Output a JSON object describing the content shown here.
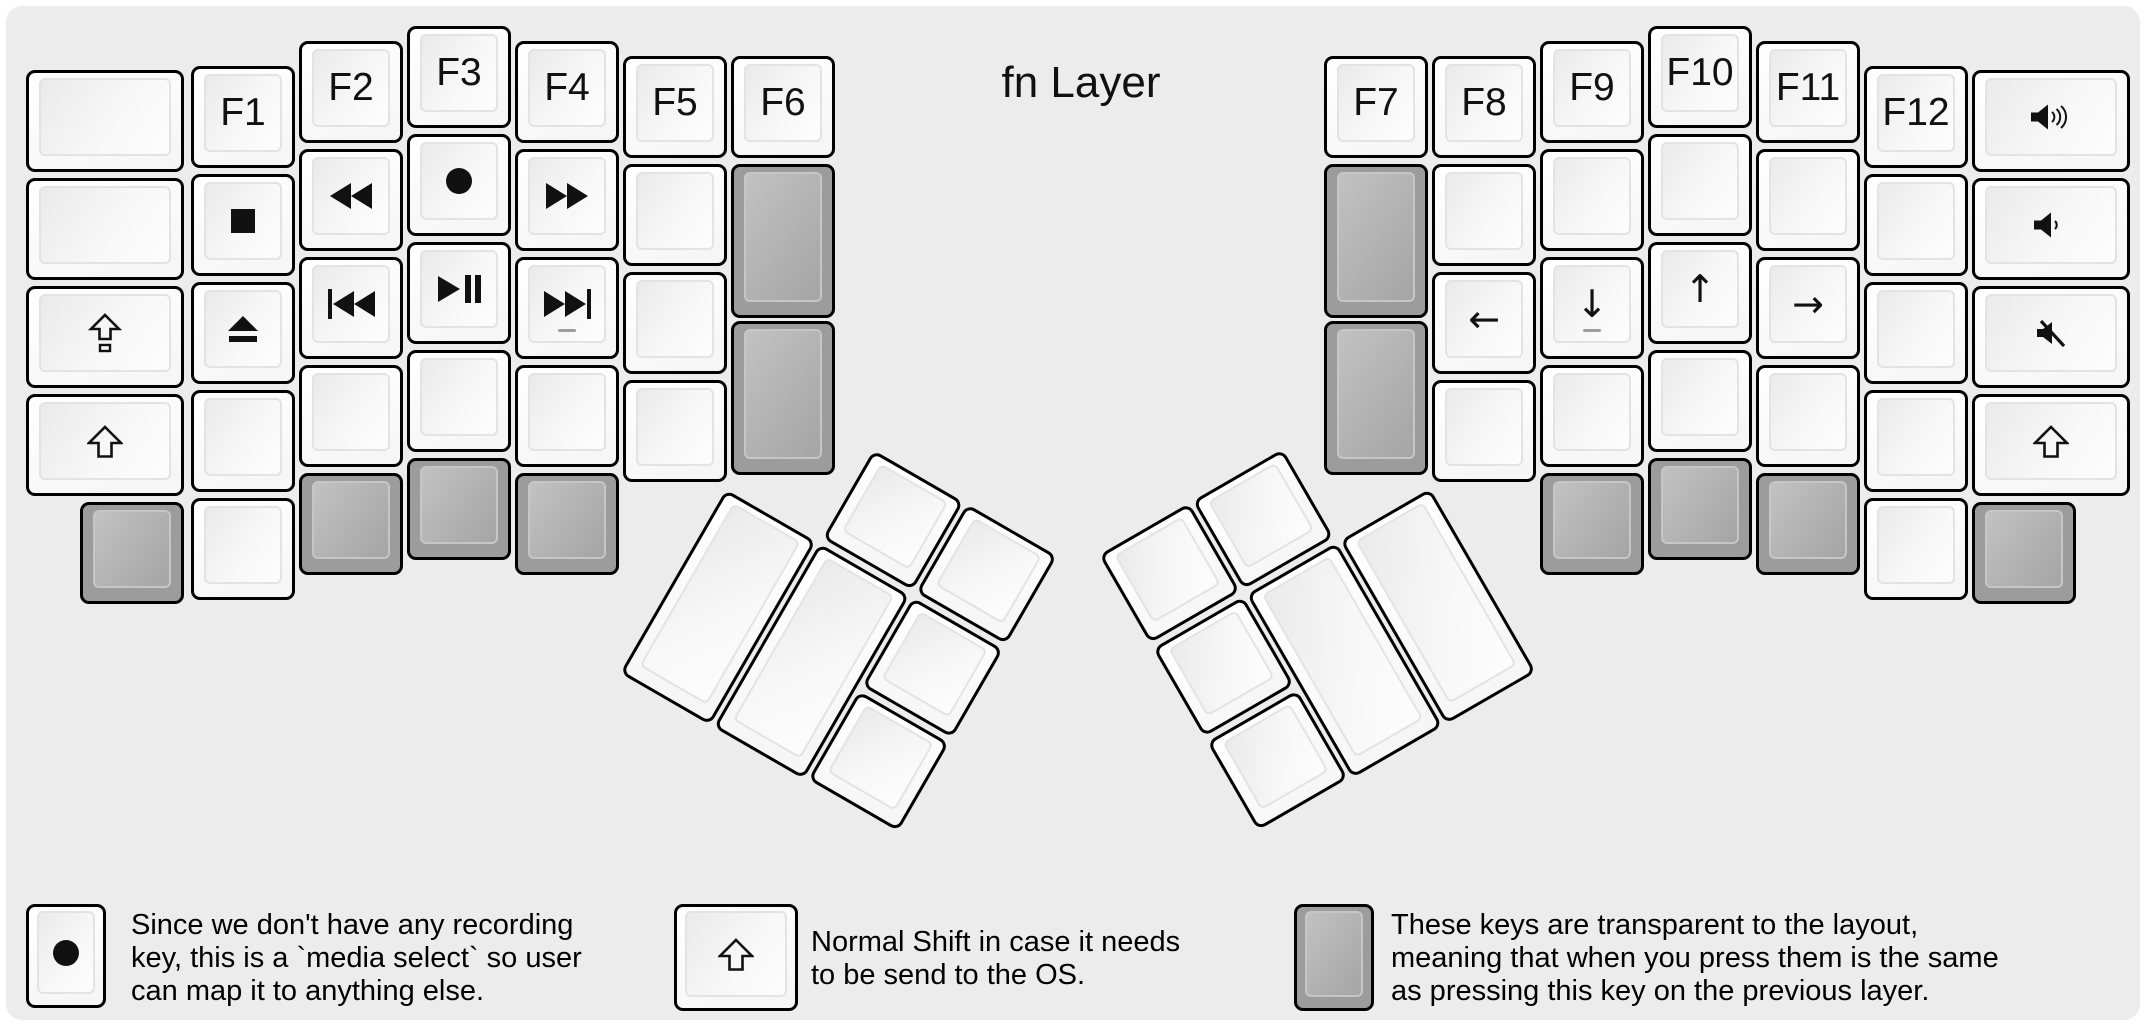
{
  "title": "fn Layer",
  "colors": {
    "panel_background": "#ececec",
    "key_border": "#000000",
    "white_key": "#f7f7f7",
    "transparent_key_gray": "#9c9c9c",
    "icon": "#111111",
    "homing_bar": "#9e9e9e"
  },
  "glyphs": {
    "arrow-left": "←",
    "arrow-down": "↓",
    "arrow-up": "↑",
    "arrow-right": "→"
  },
  "keyboard": {
    "left_main": [
      {
        "name": "blank",
        "x": 20,
        "y": 64,
        "w": 158
      },
      {
        "name": "f1",
        "label": "F1",
        "x": 185,
        "y": 60
      },
      {
        "name": "f2",
        "label": "F2",
        "x": 293,
        "y": 35
      },
      {
        "name": "f3",
        "label": "F3",
        "x": 401,
        "y": 20
      },
      {
        "name": "f4",
        "label": "F4",
        "x": 509,
        "y": 35
      },
      {
        "name": "f5",
        "label": "F5",
        "x": 617,
        "y": 50
      },
      {
        "name": "f6",
        "label": "F6",
        "x": 725,
        "y": 50
      },
      {
        "name": "blank",
        "x": 20,
        "y": 172,
        "w": 158
      },
      {
        "name": "stop",
        "icon": "stop",
        "x": 185,
        "y": 168
      },
      {
        "name": "rewind",
        "icon": "rewind",
        "x": 293,
        "y": 143
      },
      {
        "name": "record",
        "icon": "record",
        "x": 401,
        "y": 128
      },
      {
        "name": "fast-forward",
        "icon": "fast-forward",
        "x": 509,
        "y": 143
      },
      {
        "name": "blank",
        "x": 617,
        "y": 158
      },
      {
        "name": "transparent",
        "type": "gray",
        "x": 725,
        "y": 158,
        "h": 154
      },
      {
        "name": "caps-lock",
        "icon": "caps-lock",
        "x": 20,
        "y": 280,
        "w": 158
      },
      {
        "name": "eject",
        "icon": "eject",
        "x": 185,
        "y": 276
      },
      {
        "name": "prev-track",
        "icon": "prev-track",
        "x": 293,
        "y": 251
      },
      {
        "name": "play-pause",
        "icon": "play-pause",
        "x": 401,
        "y": 236
      },
      {
        "name": "next-track",
        "icon": "next-track",
        "x": 509,
        "y": 251,
        "homing": true
      },
      {
        "name": "blank",
        "x": 617,
        "y": 266
      },
      {
        "name": "transparent",
        "type": "gray",
        "x": 725,
        "y": 315,
        "h": 154
      },
      {
        "name": "shift",
        "icon": "shift",
        "x": 20,
        "y": 388,
        "w": 158
      },
      {
        "name": "blank",
        "x": 185,
        "y": 384
      },
      {
        "name": "blank",
        "x": 293,
        "y": 359
      },
      {
        "name": "blank",
        "x": 401,
        "y": 344
      },
      {
        "name": "blank",
        "x": 509,
        "y": 359
      },
      {
        "name": "blank",
        "x": 617,
        "y": 374
      },
      {
        "name": "transparent",
        "type": "gray",
        "x": 74,
        "y": 496
      },
      {
        "name": "blank",
        "x": 185,
        "y": 492
      },
      {
        "name": "transparent",
        "type": "gray",
        "x": 293,
        "y": 467
      },
      {
        "name": "transparent",
        "type": "gray",
        "x": 401,
        "y": 452
      },
      {
        "name": "transparent",
        "type": "gray",
        "x": 509,
        "y": 467
      }
    ],
    "right_main": [
      {
        "name": "f7",
        "label": "F7",
        "x": 1318,
        "y": 50
      },
      {
        "name": "f8",
        "label": "F8",
        "x": 1426,
        "y": 50
      },
      {
        "name": "f9",
        "label": "F9",
        "x": 1534,
        "y": 35
      },
      {
        "name": "f10",
        "label": "F10",
        "x": 1642,
        "y": 20
      },
      {
        "name": "f11",
        "label": "F11",
        "x": 1750,
        "y": 35
      },
      {
        "name": "f12",
        "label": "F12",
        "x": 1858,
        "y": 60
      },
      {
        "name": "volume-up",
        "icon": "volume-up",
        "x": 1966,
        "y": 64,
        "w": 158
      },
      {
        "name": "transparent",
        "type": "gray",
        "x": 1318,
        "y": 158,
        "h": 154
      },
      {
        "name": "blank",
        "x": 1426,
        "y": 158
      },
      {
        "name": "blank",
        "x": 1534,
        "y": 143
      },
      {
        "name": "blank",
        "x": 1642,
        "y": 128
      },
      {
        "name": "blank",
        "x": 1750,
        "y": 143
      },
      {
        "name": "blank",
        "x": 1858,
        "y": 168
      },
      {
        "name": "volume-down",
        "icon": "volume-down",
        "x": 1966,
        "y": 172,
        "w": 158
      },
      {
        "name": "transparent",
        "type": "gray",
        "x": 1318,
        "y": 315,
        "h": 154
      },
      {
        "name": "arrow-left",
        "icon": "arrow-left",
        "x": 1426,
        "y": 266
      },
      {
        "name": "arrow-down",
        "icon": "arrow-down",
        "x": 1534,
        "y": 251,
        "homing": true
      },
      {
        "name": "arrow-up",
        "icon": "arrow-up",
        "x": 1642,
        "y": 236
      },
      {
        "name": "arrow-right",
        "icon": "arrow-right",
        "x": 1750,
        "y": 251
      },
      {
        "name": "blank",
        "x": 1858,
        "y": 276
      },
      {
        "name": "mute",
        "icon": "mute",
        "x": 1966,
        "y": 280,
        "w": 158
      },
      {
        "name": "blank",
        "x": 1426,
        "y": 374
      },
      {
        "name": "blank",
        "x": 1534,
        "y": 359
      },
      {
        "name": "blank",
        "x": 1642,
        "y": 344
      },
      {
        "name": "blank",
        "x": 1750,
        "y": 359
      },
      {
        "name": "blank",
        "x": 1858,
        "y": 384
      },
      {
        "name": "shift",
        "icon": "shift",
        "x": 1966,
        "y": 388,
        "w": 158
      },
      {
        "name": "transparent",
        "type": "gray",
        "x": 1534,
        "y": 467
      },
      {
        "name": "transparent",
        "type": "gray",
        "x": 1642,
        "y": 452
      },
      {
        "name": "transparent",
        "type": "gray",
        "x": 1750,
        "y": 467
      },
      {
        "name": "blank",
        "x": 1858,
        "y": 492
      },
      {
        "name": "transparent",
        "type": "gray",
        "x": 1966,
        "y": 496
      }
    ],
    "left_thumb": {
      "rotation": 30,
      "keys": [
        {
          "name": "blank",
          "x": 108,
          "y": 0
        },
        {
          "name": "blank",
          "x": 216,
          "y": 0
        },
        {
          "name": "blank",
          "x": 0,
          "y": 108,
          "h": 212
        },
        {
          "name": "blank",
          "x": 108,
          "y": 108,
          "h": 212
        },
        {
          "name": "blank",
          "x": 216,
          "y": 108
        },
        {
          "name": "blank",
          "x": 216,
          "y": 216
        }
      ]
    },
    "right_thumb": {
      "rotation": -30,
      "keys": [
        {
          "name": "blank",
          "x": 0,
          "y": 0
        },
        {
          "name": "blank",
          "x": 108,
          "y": 0
        },
        {
          "name": "blank",
          "x": 0,
          "y": 108
        },
        {
          "name": "blank",
          "x": 108,
          "y": 108,
          "h": 212
        },
        {
          "name": "blank",
          "x": 216,
          "y": 108,
          "h": 212
        },
        {
          "name": "blank",
          "x": 0,
          "y": 216
        }
      ]
    }
  },
  "legend": [
    {
      "key_type": "white",
      "key_icon": "record",
      "lines": [
        "Since we don't have any recording",
        "key, this is a `media select` so user",
        "can map it to anything else."
      ]
    },
    {
      "key_type": "white",
      "key_icon": "shift",
      "lines": [
        "Normal Shift in case it needs",
        "to be send to the OS."
      ]
    },
    {
      "key_type": "gray",
      "key_icon": null,
      "lines": [
        "These keys are transparent to the layout,",
        "meaning that when you press them is the same",
        "as pressing this key on the previous layer."
      ]
    }
  ]
}
